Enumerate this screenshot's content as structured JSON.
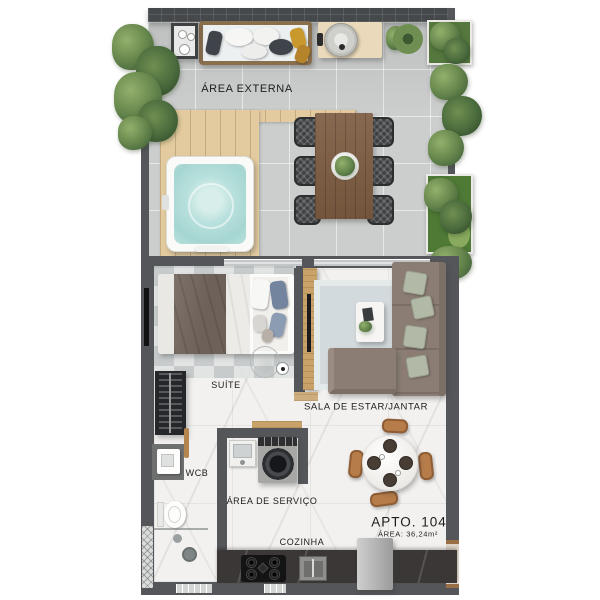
{
  "plan": {
    "apto_label": "APTO. 104",
    "area_label": "ÁREA: 36,24m²",
    "rooms": {
      "area_externa": "ÁREA EXTERNA",
      "suite": "SUÍTE",
      "sala": "SALA DE ESTAR/JANTAR",
      "wcb": "WCB",
      "area_servico": "ÁREA DE SERVIÇO",
      "cozinha": "COZINHA"
    }
  },
  "colors": {
    "wall": "#54565a",
    "brick": "#46494c",
    "ext_floor": "#c9cbcb",
    "deck": "#e3cb9f",
    "water": "#b7e0dc",
    "marble": "#f2f1ef",
    "counter": "#3a3736",
    "sofa": "#8b7d74",
    "cushion": "#b2b9a7",
    "duvet": "#6e6159",
    "pillow_blue": "#72849e",
    "rug_living": "#d3dadd",
    "chair_dark": "#3d3f41",
    "chair_tan": "#b67c4a",
    "wood": "#c8a269",
    "plant": "#62834a",
    "gold": "#c9992e",
    "label": "#1d1d1d"
  }
}
